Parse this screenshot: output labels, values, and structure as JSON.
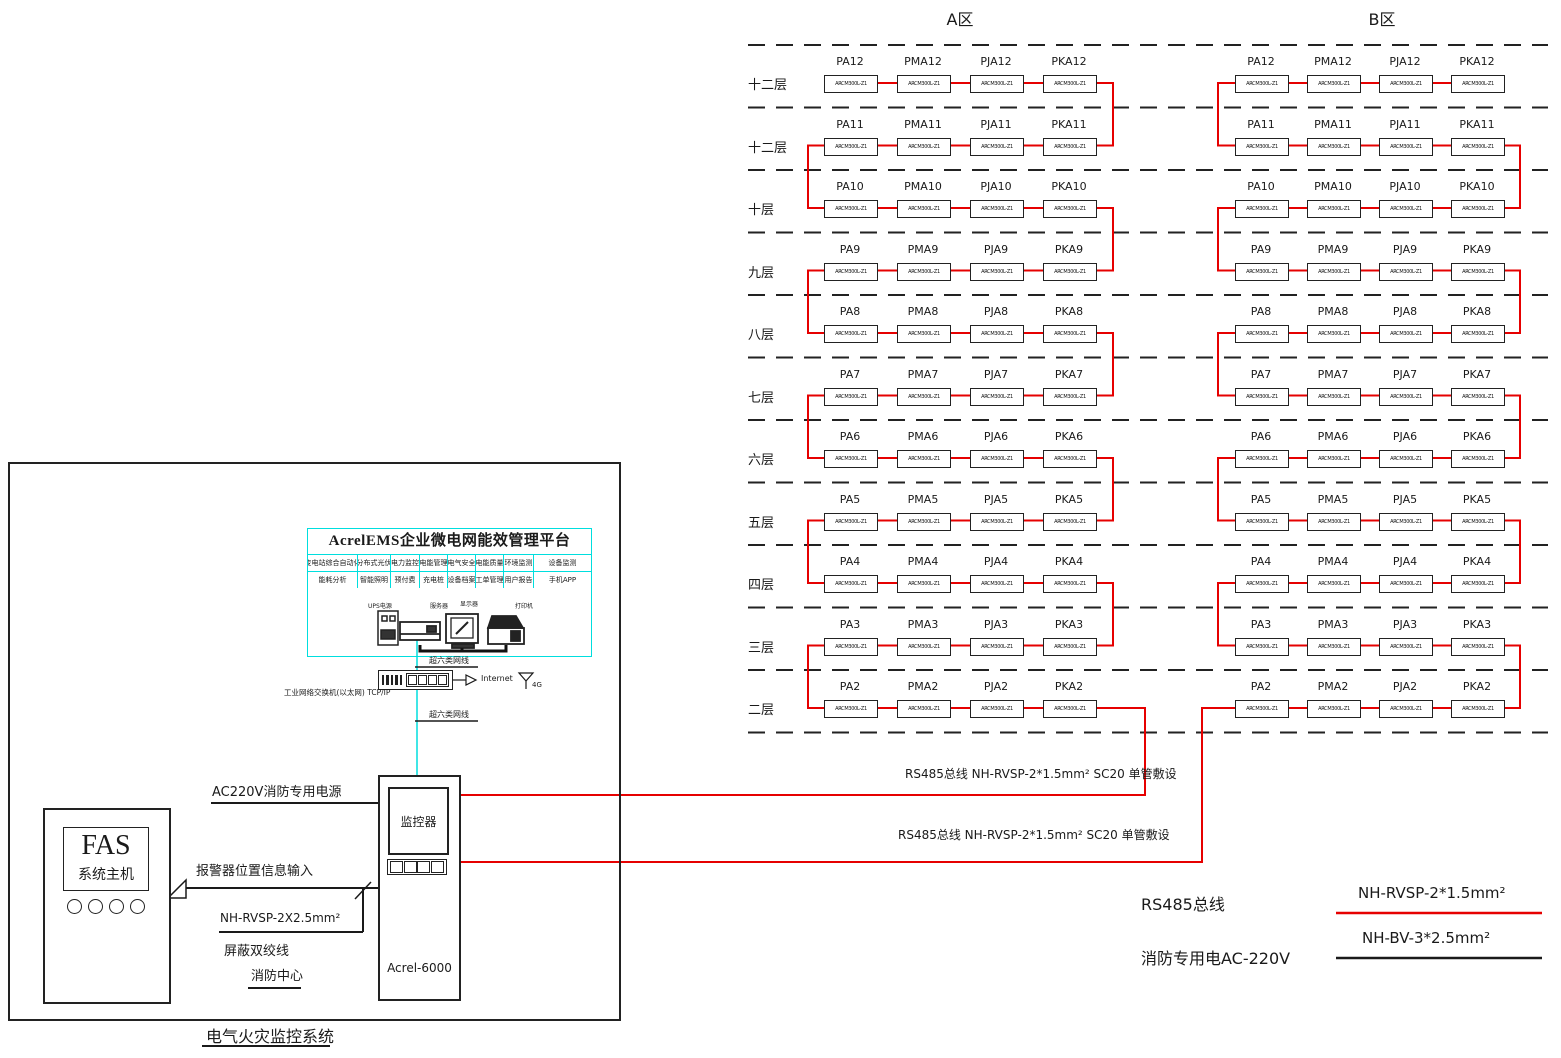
{
  "zones": [
    {
      "name": "A区"
    },
    {
      "name": "B区"
    }
  ],
  "floors": [
    {
      "label": "十二层",
      "num": "12"
    },
    {
      "label": "十二层",
      "num": "11"
    },
    {
      "label": "十层",
      "num": "10"
    },
    {
      "label": "九层",
      "num": "9"
    },
    {
      "label": "八层",
      "num": "8"
    },
    {
      "label": "七层",
      "num": "7"
    },
    {
      "label": "六层",
      "num": "6"
    },
    {
      "label": "五层",
      "num": "5"
    },
    {
      "label": "四层",
      "num": "4"
    },
    {
      "label": "三层",
      "num": "3"
    },
    {
      "label": "二层",
      "num": "2"
    }
  ],
  "device_columns": [
    "PA",
    "PMA",
    "PJA",
    "PKA"
  ],
  "device_model": "ARCM300L-Z1",
  "platform": {
    "title": "AcrelEMS企业微电网能效管理平台",
    "features_row1": [
      "变电站综合自动化",
      "分布式光伏",
      "电力监控",
      "电能管理",
      "电气安全",
      "电能质量",
      "环境监测",
      "设备监测"
    ],
    "features_row2": [
      "能耗分析",
      "智能照明",
      "预付费",
      "充电桩",
      "设备档案",
      "工单管理",
      "用户报告",
      "手机APP"
    ],
    "devices": [
      "UPS电源",
      "服务器",
      "显示器",
      "打印机"
    ]
  },
  "network": {
    "cable_label_top": "超六类网线",
    "cable_label_bottom": "超六类网线",
    "switch_label": "工业网络交换机(以太网) TCP/IP",
    "internet_label": "Internet",
    "wireless_label": "4G"
  },
  "fas": {
    "name": "FAS",
    "subtitle": "系统主机"
  },
  "monitor": {
    "screen_label": "监控器",
    "model": "Acrel-6000"
  },
  "left_labels": {
    "power": "AC220V消防专用电源",
    "alarm_input": "报警器位置信息输入",
    "cable_spec": "NH-RVSP-2X2.5mm²",
    "shielded_pair": "屏蔽双绞线",
    "fire_center": "消防中心",
    "system_title": "电气火灾监控系统"
  },
  "rs485_runs": [
    "RS485总线 NH-RVSP-2*1.5mm² SC20 单管敷设",
    "RS485总线 NH-RVSP-2*1.5mm² SC20 单管敷设"
  ],
  "legend": {
    "rs485": "RS485总线",
    "fire_power": "消防专用电AC-220V",
    "red_wire": "NH-RVSP-2*1.5mm²",
    "black_wire": "NH-BV-3*2.5mm²"
  },
  "colors": {
    "bus_red": "#e60000",
    "network_cyan": "#00dede",
    "ink": "#1a1a1a"
  }
}
